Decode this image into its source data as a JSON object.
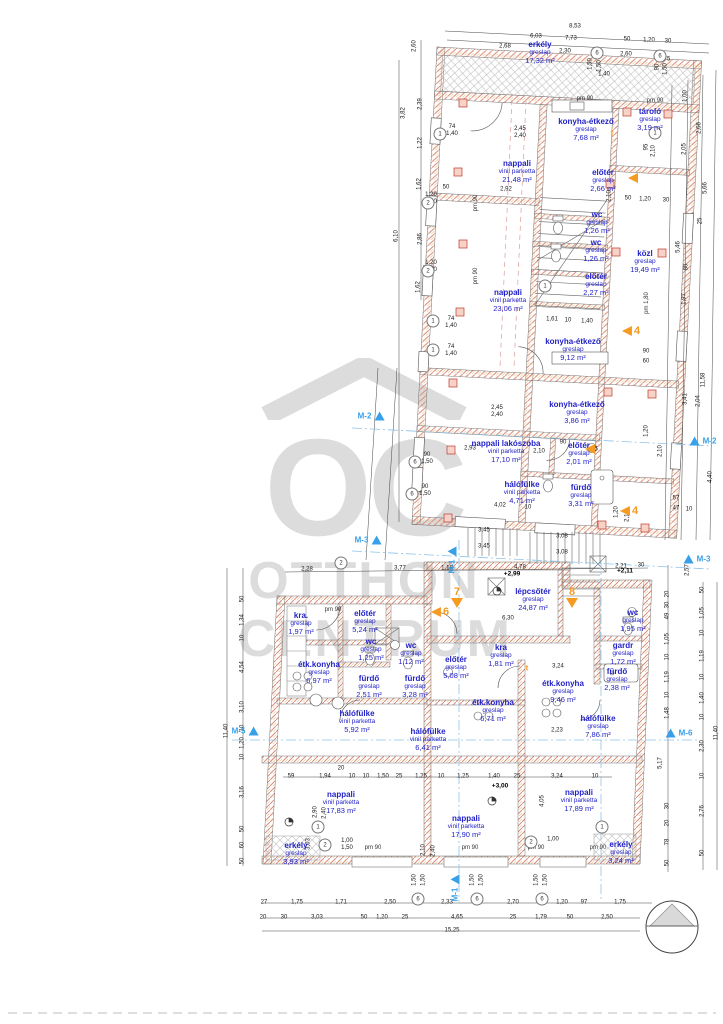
{
  "watermark": {
    "brand_oc": "OC",
    "brand_otthon": "OTTHON",
    "brand_centrum": "CENTRUM",
    "color": "#c6c6c6"
  },
  "colors": {
    "room_text": "#2222c8",
    "dim_text": "#1a1a1a",
    "wall_hatch": "#d98c7a",
    "accent_hatch": "#e7c98f",
    "orange_marker": "#f59b22",
    "section_marker": "#38a0e8",
    "red_cross": "#c0392b"
  },
  "rooms": [
    [
      "erkély",
      "greslap",
      "17,32 m²",
      540,
      53
    ],
    [
      "konyha-étkező",
      "greslap",
      "7,68 m²",
      586,
      130
    ],
    [
      "tároló",
      "greslap",
      "3,19 m²",
      650,
      120
    ],
    [
      "nappali",
      "vinil parketta",
      "21,48 m²",
      517,
      172
    ],
    [
      "előtér",
      "greslap",
      "2,66 m²",
      603,
      181
    ],
    [
      "wc",
      "greslap",
      "1,26 m²",
      597,
      223
    ],
    [
      "wc",
      "greslap",
      "1,26 m²",
      596,
      251
    ],
    [
      "közl",
      "greslap",
      "19,49 m²",
      645,
      262
    ],
    [
      "előtér",
      "greslap",
      "2,27 m²",
      596,
      285
    ],
    [
      "nappali",
      "vinil parketta",
      "23,06 m²",
      508,
      301
    ],
    [
      "konyha-étkező",
      "greslap",
      "9,12 m²",
      573,
      350
    ],
    [
      "konyha-étkező",
      "greslap",
      "3,86 m²",
      577,
      413
    ],
    [
      "nappali lakószoba",
      "vinil parketta",
      "17,10 m²",
      506,
      452
    ],
    [
      "előtér",
      "greslap",
      "2,01 m²",
      579,
      454
    ],
    [
      "hálófülke",
      "vinil parketta",
      "4,71 m²",
      522,
      493
    ],
    [
      "fürdő",
      "greslap",
      "3,31 m²",
      581,
      496
    ],
    [
      "lépcsőtér",
      "greslap",
      "24,87 m²",
      533,
      600
    ],
    [
      "kra.",
      "greslap",
      "1,97 m²",
      301,
      624
    ],
    [
      "előtér",
      "greslap",
      "5,24 m²",
      365,
      622
    ],
    [
      "wc",
      "greslap",
      "1,25 m²",
      371,
      650
    ],
    [
      "wc",
      "greslap",
      "1,12 m²",
      411,
      654
    ],
    [
      "étk.konyha",
      "greslap",
      "6,97 m²",
      319,
      673
    ],
    [
      "fürdő",
      "greslap",
      "2,51 m²",
      369,
      687
    ],
    [
      "fürdő",
      "greslap",
      "3,28 m²",
      415,
      687
    ],
    [
      "előtér",
      "greslap",
      "5,08 m²",
      456,
      668
    ],
    [
      "wc",
      "greslap",
      "1,95 m²",
      633,
      621
    ],
    [
      "gardr",
      "greslap",
      "1,72 m²",
      623,
      654
    ],
    [
      "kra",
      "greslap",
      "1,81 m²",
      501,
      656
    ],
    [
      "étk.konyha",
      "greslap",
      "9,46 m²",
      563,
      692
    ],
    [
      "étk.konyha",
      "greslap",
      "6,71 m²",
      493,
      711
    ],
    [
      "fürdő",
      "greslap",
      "2,38 m²",
      617,
      680
    ],
    [
      "hálófülke",
      "vinil parketta",
      "5,92 m²",
      357,
      722
    ],
    [
      "hálófülke",
      "vinil parketta",
      "6,41 m²",
      428,
      740
    ],
    [
      "hálófülke",
      "greslap",
      "7,86 m²",
      598,
      727
    ],
    [
      "nappali",
      "vinil parketta",
      "17,83 m²",
      341,
      803
    ],
    [
      "nappali",
      "vinil parketta",
      "17,90 m²",
      466,
      827
    ],
    [
      "nappali",
      "vinil parketta",
      "17,89 m²",
      579,
      801
    ],
    [
      "erkély",
      "greslap",
      "3,93 m²",
      296,
      854
    ],
    [
      "erkély",
      "greslap",
      "3,24 m²",
      621,
      853
    ]
  ],
  "dims": [
    [
      "8,53",
      575,
      27,
      0
    ],
    [
      "6,03",
      536,
      37,
      0
    ],
    [
      "7,73",
      571,
      39,
      0
    ],
    [
      "50",
      627,
      40,
      0
    ],
    [
      "1,20",
      649,
      41,
      0
    ],
    [
      "30",
      668,
      42,
      0
    ],
    [
      "2,68",
      505,
      47,
      0
    ],
    [
      "2,30",
      565,
      52,
      0
    ],
    [
      "2,60",
      626,
      55,
      0
    ],
    [
      "75",
      667,
      60,
      0
    ],
    [
      "1,50",
      591,
      64,
      1
    ],
    [
      "1,50",
      600,
      66,
      1
    ],
    [
      "90",
      658,
      67,
      1
    ],
    [
      "1,50",
      666,
      69,
      1
    ],
    [
      "1,40",
      604,
      75,
      0
    ],
    [
      "2,45\n2,40",
      520,
      133,
      0
    ],
    [
      "74\n1,40",
      452,
      131,
      0
    ],
    [
      "2,92",
      506,
      190,
      0
    ],
    [
      "1,20\n1,50",
      431,
      199,
      0
    ],
    [
      "1,20\n1,50",
      431,
      267,
      0
    ],
    [
      "74\n1,40",
      451,
      323,
      0
    ],
    [
      "74\n1,40",
      451,
      351,
      0
    ],
    [
      "90\n1,50",
      427,
      459,
      0
    ],
    [
      "90\n1,50",
      425,
      491,
      0
    ],
    [
      "2,45\n2,40",
      497,
      412,
      0
    ],
    [
      "50",
      446,
      188,
      0
    ],
    [
      "2,60",
      415,
      46,
      1
    ],
    [
      "2,39",
      421,
      104,
      1
    ],
    [
      "3,82",
      404,
      113,
      1
    ],
    [
      "1,22",
      421,
      143,
      1
    ],
    [
      "1,62",
      420,
      184,
      1
    ],
    [
      "6,10",
      397,
      236,
      1
    ],
    [
      "2,86",
      421,
      239,
      1
    ],
    [
      "1,62",
      419,
      287,
      1
    ],
    [
      "1,61",
      552,
      320,
      0
    ],
    [
      "10",
      568,
      321,
      0
    ],
    [
      "1,40",
      587,
      322,
      0
    ],
    [
      "2,93",
      470,
      449,
      0
    ],
    [
      "2,10",
      539,
      452,
      0
    ],
    [
      "1,05",
      592,
      450,
      0
    ],
    [
      "90",
      563,
      443,
      0
    ],
    [
      "4,02",
      500,
      506,
      0
    ],
    [
      "10",
      528,
      508,
      0
    ],
    [
      "3,45",
      484,
      531,
      0
    ],
    [
      "3,45",
      484,
      547,
      0
    ],
    [
      "3,08",
      562,
      537,
      0
    ],
    [
      "3,08",
      562,
      553,
      0
    ],
    [
      "2,10",
      610,
      196,
      1
    ],
    [
      "95",
      647,
      147,
      1
    ],
    [
      "2,10",
      654,
      151,
      1
    ],
    [
      "50",
      628,
      199,
      0
    ],
    [
      "1,20",
      645,
      200,
      0
    ],
    [
      "30",
      666,
      201,
      0
    ],
    [
      "1,20",
      617,
      512,
      1
    ],
    [
      "2,10",
      628,
      516,
      1
    ],
    [
      "1,00",
      686,
      96,
      1
    ],
    [
      "2,66",
      700,
      128,
      1
    ],
    [
      "2,05",
      685,
      149,
      1
    ],
    [
      "5,66",
      706,
      188,
      1
    ],
    [
      "25",
      701,
      221,
      1
    ],
    [
      "5,46",
      679,
      247,
      1
    ],
    [
      "80",
      687,
      267,
      1
    ],
    [
      "1,97",
      685,
      299,
      1
    ],
    [
      "11,58",
      704,
      380,
      1
    ],
    [
      "3,41",
      686,
      399,
      1
    ],
    [
      "2,04",
      699,
      401,
      1
    ],
    [
      "2,10",
      661,
      451,
      1
    ],
    [
      "1,20",
      647,
      431,
      1
    ],
    [
      "4,40",
      711,
      477,
      1
    ],
    [
      "57",
      676,
      499,
      0
    ],
    [
      "47",
      676,
      509,
      0
    ],
    [
      "10",
      689,
      510,
      0
    ],
    [
      "90",
      646,
      352,
      0
    ],
    [
      "60",
      646,
      362,
      0
    ],
    [
      "2,28",
      307,
      570,
      0
    ],
    [
      "3,77",
      400,
      569,
      0
    ],
    [
      "1,18",
      447,
      569,
      0
    ],
    [
      "4,78",
      520,
      568,
      0
    ],
    [
      "2,21",
      621,
      567,
      0
    ],
    [
      "30",
      641,
      566,
      0
    ],
    [
      "6,30",
      508,
      619,
      0
    ],
    [
      "3,24",
      558,
      667,
      0
    ],
    [
      "2,23",
      557,
      731,
      0
    ],
    [
      "3,24",
      557,
      777,
      0
    ],
    [
      "4,05",
      543,
      801,
      1
    ],
    [
      "50",
      243,
      599,
      1
    ],
    [
      "1,34",
      243,
      620,
      1
    ],
    [
      "10",
      243,
      638,
      1
    ],
    [
      "4,54",
      243,
      667,
      1
    ],
    [
      "3,10",
      243,
      707,
      1
    ],
    [
      "10",
      243,
      728,
      1
    ],
    [
      "1,20",
      243,
      743,
      1
    ],
    [
      "10",
      243,
      757,
      1
    ],
    [
      "3,16",
      243,
      792,
      1
    ],
    [
      "50",
      243,
      829,
      1
    ],
    [
      "60",
      243,
      845,
      1
    ],
    [
      "50",
      243,
      861,
      1
    ],
    [
      "11,40",
      227,
      731,
      1
    ],
    [
      "2,57",
      688,
      570,
      1
    ],
    [
      "20",
      668,
      594,
      1
    ],
    [
      "30",
      668,
      605,
      1
    ],
    [
      "49",
      668,
      616,
      1
    ],
    [
      "1,05",
      668,
      639,
      1
    ],
    [
      "10",
      668,
      657,
      1
    ],
    [
      "1,19",
      668,
      677,
      1
    ],
    [
      "10",
      668,
      695,
      1
    ],
    [
      "1,48",
      668,
      713,
      1
    ],
    [
      "5,17",
      661,
      763,
      1
    ],
    [
      "30",
      668,
      806,
      1
    ],
    [
      "20",
      668,
      823,
      1
    ],
    [
      "78",
      668,
      842,
      1
    ],
    [
      "50",
      668,
      863,
      1
    ],
    [
      "50",
      703,
      590,
      1
    ],
    [
      "1,05",
      703,
      613,
      1
    ],
    [
      "10",
      703,
      633,
      1
    ],
    [
      "1,19",
      703,
      656,
      1
    ],
    [
      "10",
      703,
      677,
      1
    ],
    [
      "1,40",
      703,
      698,
      1
    ],
    [
      "10",
      703,
      717,
      1
    ],
    [
      "2,30",
      703,
      746,
      1
    ],
    [
      "10",
      703,
      776,
      1
    ],
    [
      "2,76",
      703,
      811,
      1
    ],
    [
      "50",
      703,
      853,
      1
    ],
    [
      "11,40",
      717,
      733,
      1
    ],
    [
      "59",
      291,
      777,
      0
    ],
    [
      "1,94",
      325,
      777,
      0
    ],
    [
      "20",
      341,
      769,
      0
    ],
    [
      "10",
      352,
      777,
      0
    ],
    [
      "10",
      366,
      777,
      0
    ],
    [
      "1,50",
      383,
      777,
      0
    ],
    [
      "25",
      399,
      777,
      0
    ],
    [
      "1,25",
      421,
      777,
      0
    ],
    [
      "10",
      441,
      777,
      0
    ],
    [
      "1,25",
      463,
      777,
      0
    ],
    [
      "1,40",
      494,
      777,
      0
    ],
    [
      "25",
      517,
      777,
      0
    ],
    [
      "10",
      595,
      777,
      0
    ],
    [
      "1,00\n1,50",
      347,
      845,
      0
    ],
    [
      "1,00",
      553,
      840,
      0
    ],
    [
      "3,03",
      309,
      844,
      1
    ],
    [
      "2,10",
      424,
      850,
      1
    ],
    [
      "2,40",
      434,
      851,
      1
    ],
    [
      "2,90",
      316,
      812,
      1
    ],
    [
      "2,40",
      325,
      813,
      1
    ],
    [
      "1,50",
      415,
      880,
      1
    ],
    [
      "1,50",
      424,
      880,
      1
    ],
    [
      "1,50",
      473,
      880,
      1
    ],
    [
      "1,50",
      482,
      880,
      1
    ],
    [
      "1,50",
      537,
      880,
      1
    ],
    [
      "1,50",
      546,
      880,
      1
    ],
    [
      "27",
      264,
      903,
      0
    ],
    [
      "1,75",
      297,
      903,
      0
    ],
    [
      "1,71",
      341,
      903,
      0
    ],
    [
      "2,50",
      390,
      903,
      0
    ],
    [
      "2,33",
      447,
      903,
      0
    ],
    [
      "2,70",
      513,
      903,
      0
    ],
    [
      "1,20",
      562,
      903,
      0
    ],
    [
      "97",
      584,
      903,
      0
    ],
    [
      "1,75",
      620,
      903,
      0
    ],
    [
      "20",
      263,
      918,
      0
    ],
    [
      "30",
      284,
      918,
      0
    ],
    [
      "3,03",
      317,
      918,
      0
    ],
    [
      "50",
      364,
      918,
      0
    ],
    [
      "1,20",
      382,
      918,
      0
    ],
    [
      "25",
      405,
      918,
      0
    ],
    [
      "4,65",
      457,
      918,
      0
    ],
    [
      "25",
      513,
      918,
      0
    ],
    [
      "1,79",
      541,
      918,
      0
    ],
    [
      "50",
      570,
      918,
      0
    ],
    [
      "2,50",
      607,
      918,
      0
    ],
    [
      "15,25",
      452,
      931,
      0
    ]
  ],
  "pm_labels": [
    [
      "pm 90",
      585,
      99,
      0
    ],
    [
      "pm 90",
      655,
      101,
      0
    ],
    [
      "pm 90",
      476,
      203,
      1
    ],
    [
      "pm 90",
      476,
      276,
      1
    ],
    [
      "pm 1,80",
      647,
      303,
      1
    ],
    [
      "pm 90",
      333,
      610,
      0
    ],
    [
      "pm 90",
      373,
      848,
      0
    ],
    [
      "pm 90",
      470,
      848,
      0
    ],
    [
      "pm 90",
      536,
      848,
      0
    ],
    [
      "pm 90",
      598,
      848,
      0
    ]
  ],
  "circles": [
    [
      "6",
      597,
      53
    ],
    [
      "6",
      660,
      56
    ],
    [
      "1",
      655,
      133
    ],
    [
      "1",
      440,
      134
    ],
    [
      "2",
      428,
      203
    ],
    [
      "2",
      428,
      271
    ],
    [
      "1",
      433,
      321
    ],
    [
      "1",
      433,
      350
    ],
    [
      "6",
      415,
      462
    ],
    [
      "6",
      412,
      494
    ],
    [
      "1",
      545,
      286
    ],
    [
      "2",
      341,
      563
    ],
    [
      "1",
      318,
      827
    ],
    [
      "2",
      325,
      845
    ],
    [
      "2",
      531,
      842
    ],
    [
      "1",
      602,
      827
    ],
    [
      "6",
      418,
      899
    ],
    [
      "6",
      477,
      899
    ],
    [
      "6",
      542,
      899
    ]
  ],
  "levels": [
    [
      "+2,99",
      512,
      574
    ],
    [
      "+3,00",
      500,
      786
    ],
    [
      "+2,11",
      625,
      571
    ]
  ],
  "orange_markers": [
    [
      "4",
      "left",
      631,
      331
    ],
    [
      "",
      "left",
      590,
      449
    ],
    [
      "4",
      "left",
      629,
      511
    ],
    [
      "6",
      "left",
      440,
      612
    ],
    [
      "7",
      "down",
      457,
      597
    ],
    [
      "8",
      "down",
      572,
      597
    ],
    [
      "",
      "left",
      633,
      178
    ],
    [
      "t",
      "t",
      612,
      133
    ],
    [
      "t",
      "t",
      527,
      668
    ]
  ],
  "section_markers": [
    [
      "M-2",
      "r",
      371,
      416
    ],
    [
      "M-2",
      "l",
      703,
      441
    ],
    [
      "M-3",
      "r",
      368,
      540
    ],
    [
      "M-3",
      "l",
      697,
      559
    ],
    [
      "M-5",
      "r",
      245,
      731
    ],
    [
      "M-6",
      "l",
      679,
      733
    ],
    [
      "M-1",
      "v",
      452,
      560
    ],
    [
      "M-1",
      "v",
      455,
      888
    ]
  ]
}
